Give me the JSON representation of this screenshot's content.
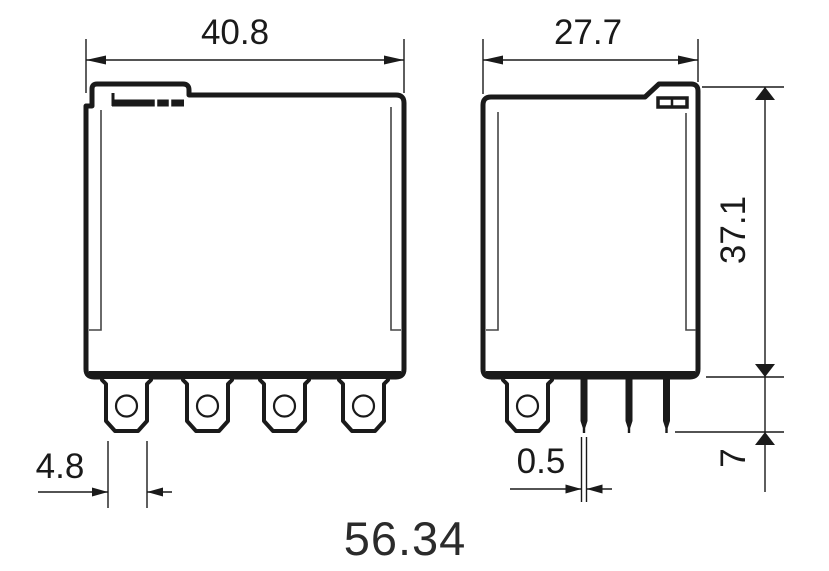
{
  "part_number": "56.34",
  "dimensions": {
    "front_width": "40.8",
    "blade_pin_width": "4.8",
    "side_width": "27.7",
    "body_height": "37.1",
    "pin_length": "7",
    "pin_thickness": "0.5"
  },
  "colors": {
    "line": "#1a1a1a",
    "text": "#1a1a1a",
    "part_number_text": "#2b2b2b",
    "background": "#ffffff"
  }
}
